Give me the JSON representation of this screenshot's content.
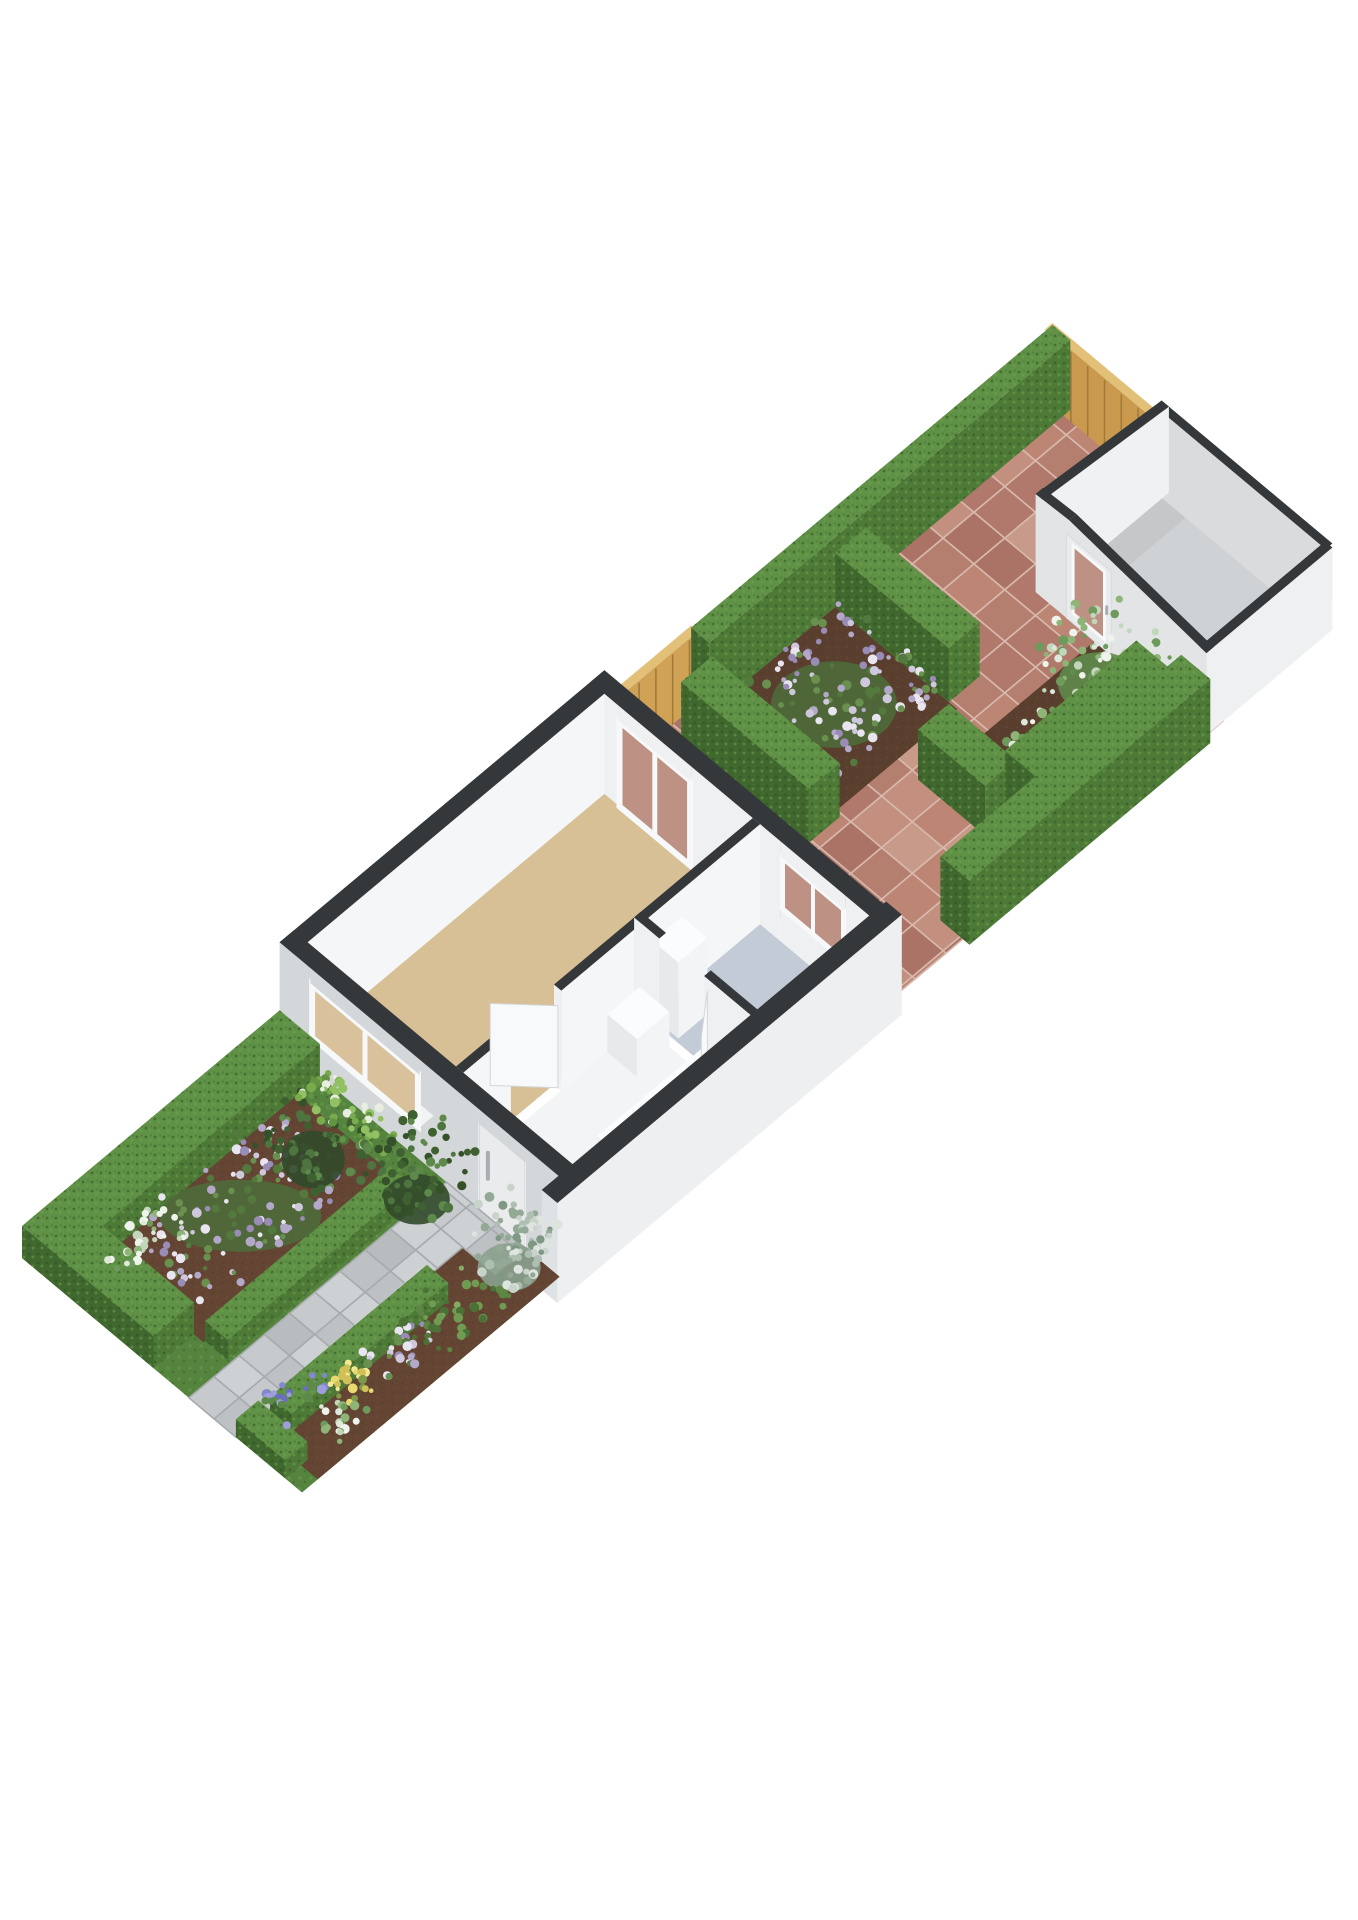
{
  "meta": {
    "title": "3D floor plan render",
    "alt": "Isometric 3D floor plan of a long narrow plot: front garden with hedged flower beds and a paved path to the front door, a single-storey house with living room, hall, stairs and bathroom, a brick-paved back patio with hedge-enclosed flower beds, wooden boundary fences and a small garden shed at the rear",
    "canvas": {
      "w": 1358,
      "h": 1920
    },
    "background": "#ffffff"
  },
  "scene": {
    "projection": {
      "origin": [
        22,
        1258
      ],
      "u": [
        56.0,
        -46.9
      ],
      "v": [
        56.0,
        46.9
      ],
      "heightScale": 40
    },
    "colors": {
      "wallTop": "#34383b",
      "wallOuterU": "#d4d7da",
      "wallOuterV": "#edeff1",
      "wallInnerU": "#eef0f2",
      "wallInnerV": "#f5f6f7",
      "floorLiving": "#d8c096",
      "floorHall": "#f3f4f5",
      "floorBath": "#c2cbd6",
      "floorShed": "#cfd2d4",
      "shedShadow": "#b7babc",
      "hedgeTop": "#5f9246",
      "hedgeU": "#3f672e",
      "hedgeV": "#4e7a38",
      "fenceTop": "#e3c078",
      "fenceU": "#c99a4e",
      "fenceV": "#cfa256",
      "plankLine": "#a3793a",
      "brickBase": "#bc8a7c",
      "bricks": [
        "#c3907f",
        "#b57f70",
        "#ab7365",
        "#c79a89",
        "#b0796c",
        "#bd8574"
      ],
      "grout": "#d8b9ad",
      "pathBase": "#c3c6c8",
      "pavers": [
        "#c7cacc",
        "#bec1c3",
        "#ced1d3",
        "#b9bcbe"
      ],
      "joints": "#a8abad",
      "grass": "#55843e",
      "soil": "#644533",
      "soilDark": "#5a3f2e",
      "glassTan": "#d9c19c",
      "glassBrick": "#bd9184",
      "frame": "#f6f8f9",
      "leaf": "#f8f9fa",
      "leafEdge": "#d3d6d9",
      "stairWood": "#d2a368",
      "stairTread": "#b7874a",
      "doorFace": "#e9ebed",
      "doorEdge": "#d8dbde",
      "handle": "#a7adb2",
      "boxTop": "#fbfcfd",
      "boxU": "#e7e9eb",
      "boxV": "#f3f4f5"
    },
    "palettes": {
      "purple": {
        "dots": [
          "#cfc8dd",
          "#e8e5f0",
          "#b3a8c9",
          "#998cb7",
          "#69904f",
          "#54793c"
        ],
        "under": "#4e6c3a"
      },
      "whiteshrub": {
        "dots": [
          "#eef3ec",
          "#dfe9db",
          "#c2d6ba",
          "#8fb478",
          "#6e9a5b"
        ],
        "under": "#5f8a4d"
      },
      "silver": {
        "dots": [
          "#c8d3ca",
          "#dde5de",
          "#aebfb2",
          "#93a996",
          "#7e9884"
        ],
        "under": "#8aa08e"
      },
      "darkgreen": {
        "dots": [
          "#5d8a4a",
          "#4e7540",
          "#35512a",
          "#3f6030"
        ],
        "under": "#31492a"
      },
      "brightgreen": {
        "dots": [
          "#79aa4c",
          "#92c164",
          "#639441",
          "#e8efe0"
        ],
        "under": "#567f38"
      },
      "lavender": {
        "dots": [
          "#8387cf",
          "#9c9fdb",
          "#6b6ec0",
          "#5e8a49"
        ],
        "under": "#55793f"
      },
      "yellow": {
        "dots": [
          "#e8da6f",
          "#f3ea92",
          "#cfc058",
          "#7d9a4b"
        ],
        "under": "#6b8743"
      },
      "green": {
        "dots": [
          "#5d8643",
          "#6f9b52",
          "#4b7136",
          "#85ad62"
        ],
        "under": "#41602f"
      }
    },
    "front_garden": {
      "grass": [
        0,
        0,
        4.6,
        5
      ],
      "soil_beds": [
        [
          0.72,
          0.72,
          4.2,
          2.52
        ],
        [
          0.28,
          3.82,
          4.05,
          5.0
        ],
        [
          4.05,
          4.4,
          4.6,
          5.0
        ]
      ],
      "path": {
        "strips": [
          [
            0,
            2.98,
            4.05,
            3.82
          ],
          [
            4.05,
            2.98,
            4.6,
            4.4
          ]
        ],
        "step": 0.45
      },
      "hedges": [
        {
          "name": "hedge-border-left",
          "b": [
            0.12,
            0,
            4.6,
            0.72,
            0.8
          ]
        },
        {
          "name": "hedge-border-front",
          "b": [
            0,
            0,
            0.72,
            2.35,
            0.8
          ]
        },
        {
          "name": "hedge-bed-inner",
          "b": [
            0.75,
            2.52,
            4.05,
            2.92,
            0.5
          ]
        },
        {
          "name": "hedge-path-side",
          "b": [
            0.55,
            3.88,
            3.35,
            4.26,
            0.45
          ]
        },
        {
          "name": "hedge-front-right",
          "b": [
            0,
            3.82,
            0.4,
            4.7,
            0.45
          ]
        }
      ],
      "clusters": [
        {
          "name": "purple-flower-bed",
          "cx": 2.35,
          "cy": 1.55,
          "w": 2.7,
          "d": 1.5,
          "n": 130,
          "h": [
            0.15,
            0.55
          ],
          "palette": "purple",
          "seed": 11,
          "under": 1
        },
        {
          "name": "white-accent-flowers",
          "cx": 1.15,
          "cy": 1.05,
          "w": 1.0,
          "d": 0.6,
          "n": 35,
          "h": [
            0.15,
            0.45
          ],
          "palette": "whiteshrub",
          "seed": 21
        },
        {
          "name": "bed-bush",
          "cx": 3.6,
          "cy": 1.6,
          "w": 1.05,
          "d": 1.2,
          "n": 60,
          "h": [
            0.25,
            0.95
          ],
          "palette": "darkgreen",
          "seed": 31,
          "under": 1
        },
        {
          "name": "window-shrubs",
          "cx": 4.32,
          "cy": 1.55,
          "w": 0.6,
          "d": 1.5,
          "n": 55,
          "h": [
            0.12,
            0.5
          ],
          "palette": "brightgreen",
          "seed": 41
        },
        {
          "name": "door-bush",
          "cx": 4.1,
          "cy": 2.95,
          "w": 1.1,
          "d": 1.05,
          "n": 75,
          "h": [
            0.3,
            1.55
          ],
          "palette": "darkgreen",
          "seed": 51,
          "under": 1
        },
        {
          "name": "silver-shrub",
          "cx": 4.2,
          "cy": 4.5,
          "w": 1.05,
          "d": 1.0,
          "n": 80,
          "h": [
            0.2,
            1.25
          ],
          "palette": "silver",
          "seed": 61,
          "under": 1
        },
        {
          "name": "lavender-spikes",
          "cx": 0.85,
          "cy": 4.0,
          "w": 0.8,
          "d": 0.55,
          "n": 26,
          "h": [
            0.2,
            0.5
          ],
          "palette": "lavender",
          "seed": 71
        },
        {
          "name": "yellow-flowers",
          "cx": 1.5,
          "cy": 4.35,
          "w": 0.6,
          "d": 0.5,
          "n": 24,
          "h": [
            0.12,
            0.4
          ],
          "palette": "yellow",
          "seed": 81
        },
        {
          "name": "white-small-flowers",
          "cx": 1.05,
          "cy": 4.62,
          "w": 0.55,
          "d": 0.5,
          "n": 22,
          "h": [
            0.1,
            0.35
          ],
          "palette": "whiteshrub",
          "seed": 91
        },
        {
          "name": "purple-small-flowers",
          "cx": 2.3,
          "cy": 4.5,
          "w": 0.95,
          "d": 0.6,
          "n": 34,
          "h": [
            0.12,
            0.45
          ],
          "palette": "purple",
          "seed": 101
        },
        {
          "name": "mixed-green-plants",
          "cx": 3.15,
          "cy": 4.55,
          "w": 1.3,
          "d": 0.8,
          "n": 40,
          "h": [
            0.1,
            0.5
          ],
          "palette": "green",
          "seed": 111
        }
      ]
    },
    "back_garden": {
      "patio": [
        [
          10.4,
          0
        ],
        [
          18.4,
          0
        ],
        [
          18.4,
          1.95
        ],
        [
          16.15,
          1.95
        ],
        [
          16.15,
          5
        ],
        [
          10.4,
          5
        ]
      ],
      "brick_step": 0.55,
      "soil_beds": [
        [
          12.0,
          0.32,
          14.2,
          2.5
        ],
        [
          13.8,
          3.0,
          16.15,
          4.62
        ]
      ],
      "fences_far": [
        {
          "name": "back-fence",
          "b": [
            18.28,
            0,
            18.4,
            2.05,
            1.8
          ],
          "face": "u"
        },
        {
          "name": "left-boundary-fence",
          "b": [
            10.45,
            0,
            11.95,
            0.12,
            1.8
          ],
          "face": "v"
        }
      ],
      "gate": {
        "name": "side-gate-fence",
        "b": [
          10.5,
          4.5,
          10.64,
          5.0,
          1.75
        ],
        "face": "u"
      },
      "hedges_far": [
        {
          "name": "left-boundary-hedge",
          "b": [
            11.95,
            0,
            18.4,
            0.32,
            1.75
          ]
        },
        {
          "name": "island-hedge-back",
          "b": [
            14.2,
            0.32,
            14.75,
            2.35,
            1.35
          ]
        }
      ],
      "hedges_mid": [
        {
          "name": "island-hedge-front",
          "b": [
            11.45,
            0.32,
            12.0,
            2.6,
            1.35
          ]
        }
      ],
      "hedges_near": [
        {
          "name": "shedbed-hedge-cross",
          "b": [
            13.1,
            2.9,
            13.65,
            4.1,
            1.25
          ]
        },
        {
          "name": "shedbed-hedge-long",
          "b": [
            13.65,
            3.9,
            16.0,
            4.45,
            1.25
          ]
        },
        {
          "name": "right-boundary-hedge",
          "b": [
            11.8,
            4.6,
            16.1,
            5.12,
            1.6
          ]
        }
      ],
      "clusters": [
        {
          "name": "island-flowers",
          "cx": 13.1,
          "cy": 1.4,
          "w": 2.1,
          "d": 1.8,
          "n": 150,
          "h": [
            0.2,
            0.6
          ],
          "palette": "purple",
          "seed": 121,
          "under": 1
        },
        {
          "name": "shed-shrub-a",
          "cx": 14.6,
          "cy": 4.1,
          "w": 1.5,
          "d": 1.1,
          "n": 70,
          "h": [
            0.3,
            1.25
          ],
          "palette": "whiteshrub",
          "seed": 131,
          "under": 1
        },
        {
          "name": "shed-shrub-b",
          "cx": 15.7,
          "cy": 3.55,
          "w": 1.4,
          "d": 1.3,
          "n": 85,
          "h": [
            0.3,
            1.45
          ],
          "palette": "whiteshrub",
          "seed": 141,
          "under": 1
        }
      ]
    },
    "shed": {
      "floor": [
        16.15,
        1.95,
        18.4,
        5.0
      ],
      "peak_y": 2.55,
      "h_front_left": 2.45,
      "h_peak": 2.5,
      "h_back": 2.15,
      "h_right": 2.05,
      "door": {
        "y": [
          2.5,
          3.3
        ],
        "top": 2.1
      }
    },
    "house": {
      "wall_h": 2.5,
      "floors": [
        {
          "name": "living-room-floor",
          "r": [
            4.85,
            0.25,
            10.15,
            2.9
          ],
          "color": "floorLiving"
        },
        {
          "name": "hall-floor",
          "r": [
            4.85,
            3.03,
            8.03,
            4.98
          ],
          "color": "floorHall"
        },
        {
          "name": "bathroom-floor",
          "r": [
            8.15,
            3.03,
            10.15,
            4.98
          ],
          "color": "floorBath"
        }
      ],
      "stairs": {
        "r": [
          6.05,
          4.32,
          8.03,
          4.98
        ],
        "treads": 5,
        "stringer": [
          6.05,
          4.22,
          8.03,
          4.32,
          0.9
        ]
      },
      "counter": [
        7.42,
        3.03,
        8.0,
        3.56,
        0.95
      ],
      "cabinet": [
        8.2,
        3.06,
        8.72,
        3.52,
        1.9
      ],
      "front_wall": {
        "x": 4.6,
        "th": 0.25,
        "segs": [
          [
            0,
            0.55
          ],
          [
            2.5,
            3.55
          ],
          [
            4.4,
            5
          ]
        ],
        "window": {
          "y": [
            0.55,
            2.5
          ],
          "sill": 0.8,
          "top": 2.12
        },
        "door": {
          "y": [
            3.55,
            4.4
          ],
          "top": 2.15,
          "handle_y": 3.72
        }
      },
      "back_wall": {
        "x": 10.15,
        "th": 0.25,
        "segs": [
          [
            0,
            0.5
          ],
          [
            1.8,
            3.4
          ],
          [
            4.55,
            5
          ]
        ],
        "french_door": {
          "y": [
            0.5,
            1.8
          ],
          "top": 2.12
        },
        "window": {
          "y": [
            3.4,
            4.55
          ],
          "sill": 0.85,
          "top": 2.12
        }
      },
      "left_wall": {
        "y": 0,
        "th": 0.25,
        "x": [
          4.6,
          10.4
        ]
      },
      "party_wall": {
        "b": [
          4.3,
          4.98,
          10.45,
          5.26,
          2.5
        ]
      },
      "wall_a": {
        "y": 2.9,
        "th": 0.13,
        "segs": [
          [
            4.85,
            5.7
          ],
          [
            6.6,
            10.15
          ]
        ]
      },
      "wall_b": {
        "x": 8.03,
        "th": 0.12,
        "segs": [
          [
            2.9,
            3.35
          ],
          [
            4.15,
            5
          ]
        ]
      },
      "door_leaves": [
        {
          "name": "living-room-door-leaf",
          "hinge": [
            6.6,
            2.97
          ],
          "tip": [
            6.02,
            2.34
          ],
          "h": 2.05
        },
        {
          "name": "bathroom-door-leaf",
          "hinge": [
            8.09,
            4.15
          ],
          "tip": [
            7.55,
            4.58
          ],
          "h": 2.05
        }
      ]
    }
  }
}
